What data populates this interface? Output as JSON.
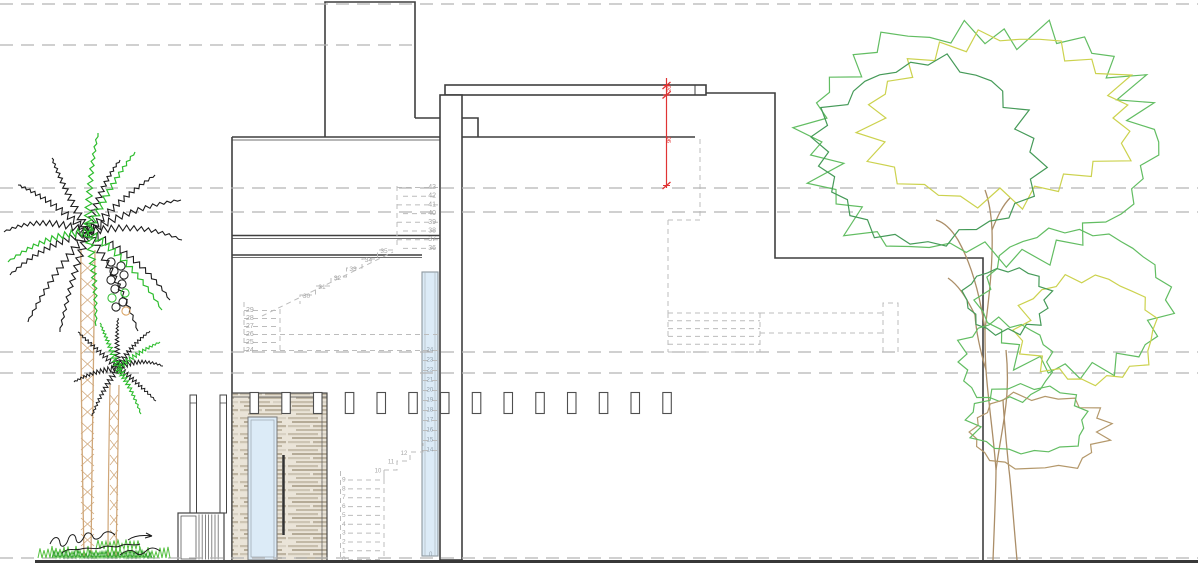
{
  "meta": {
    "drawing_type": "architectural side elevation (CAD)",
    "background": "#ffffff"
  },
  "palette": {
    "line": "#3f3f3f",
    "line_soft": "#6b6b6b",
    "guide": "#b4b4b4",
    "hidden": "#bcbcbc",
    "hidden_text": "#a6a6a6",
    "window_text": "#93a0ab",
    "glass": "#dcebf7",
    "glass_frame": "#8d979f",
    "red": "#e03434",
    "wood_bg": "#eae4d8",
    "wood_frame": "#4a4a4a",
    "palm_black": "#1c1c1c",
    "palm_green": "#2ebd2e",
    "palm_trunk": "#cfa678",
    "grass_green": "#55c040",
    "grass_dark": "#2f9e2f",
    "tree_green": "#62bd62",
    "tree_dark_green": "#459a58",
    "tree_yellow": "#ccd24e",
    "tree_brown": "#b4986b",
    "tree_trunk": "#ab8e68",
    "ground": "#383838",
    "ink": "#1b1b1b"
  },
  "dimension": {
    "labels": [
      "20",
      "90"
    ]
  },
  "stair_numbers": {
    "upper_flight": [
      "43",
      "42",
      "41",
      "40",
      "39",
      "38",
      "37",
      "36"
    ],
    "mid_flight": [
      "35",
      "34",
      "33",
      "32",
      "31",
      "30"
    ],
    "landing": [
      "29",
      "28",
      "27",
      "26",
      "25",
      "24"
    ],
    "window_flight": [
      "24",
      "23",
      "22",
      "21",
      "20",
      "19",
      "18",
      "17",
      "16",
      "15",
      "14"
    ],
    "lower_steps": [
      "12",
      "11",
      "10"
    ],
    "bottom_flight": [
      "9",
      "8",
      "7",
      "6",
      "5",
      "4",
      "3",
      "2",
      "1",
      "0"
    ],
    "window_base": "0"
  }
}
